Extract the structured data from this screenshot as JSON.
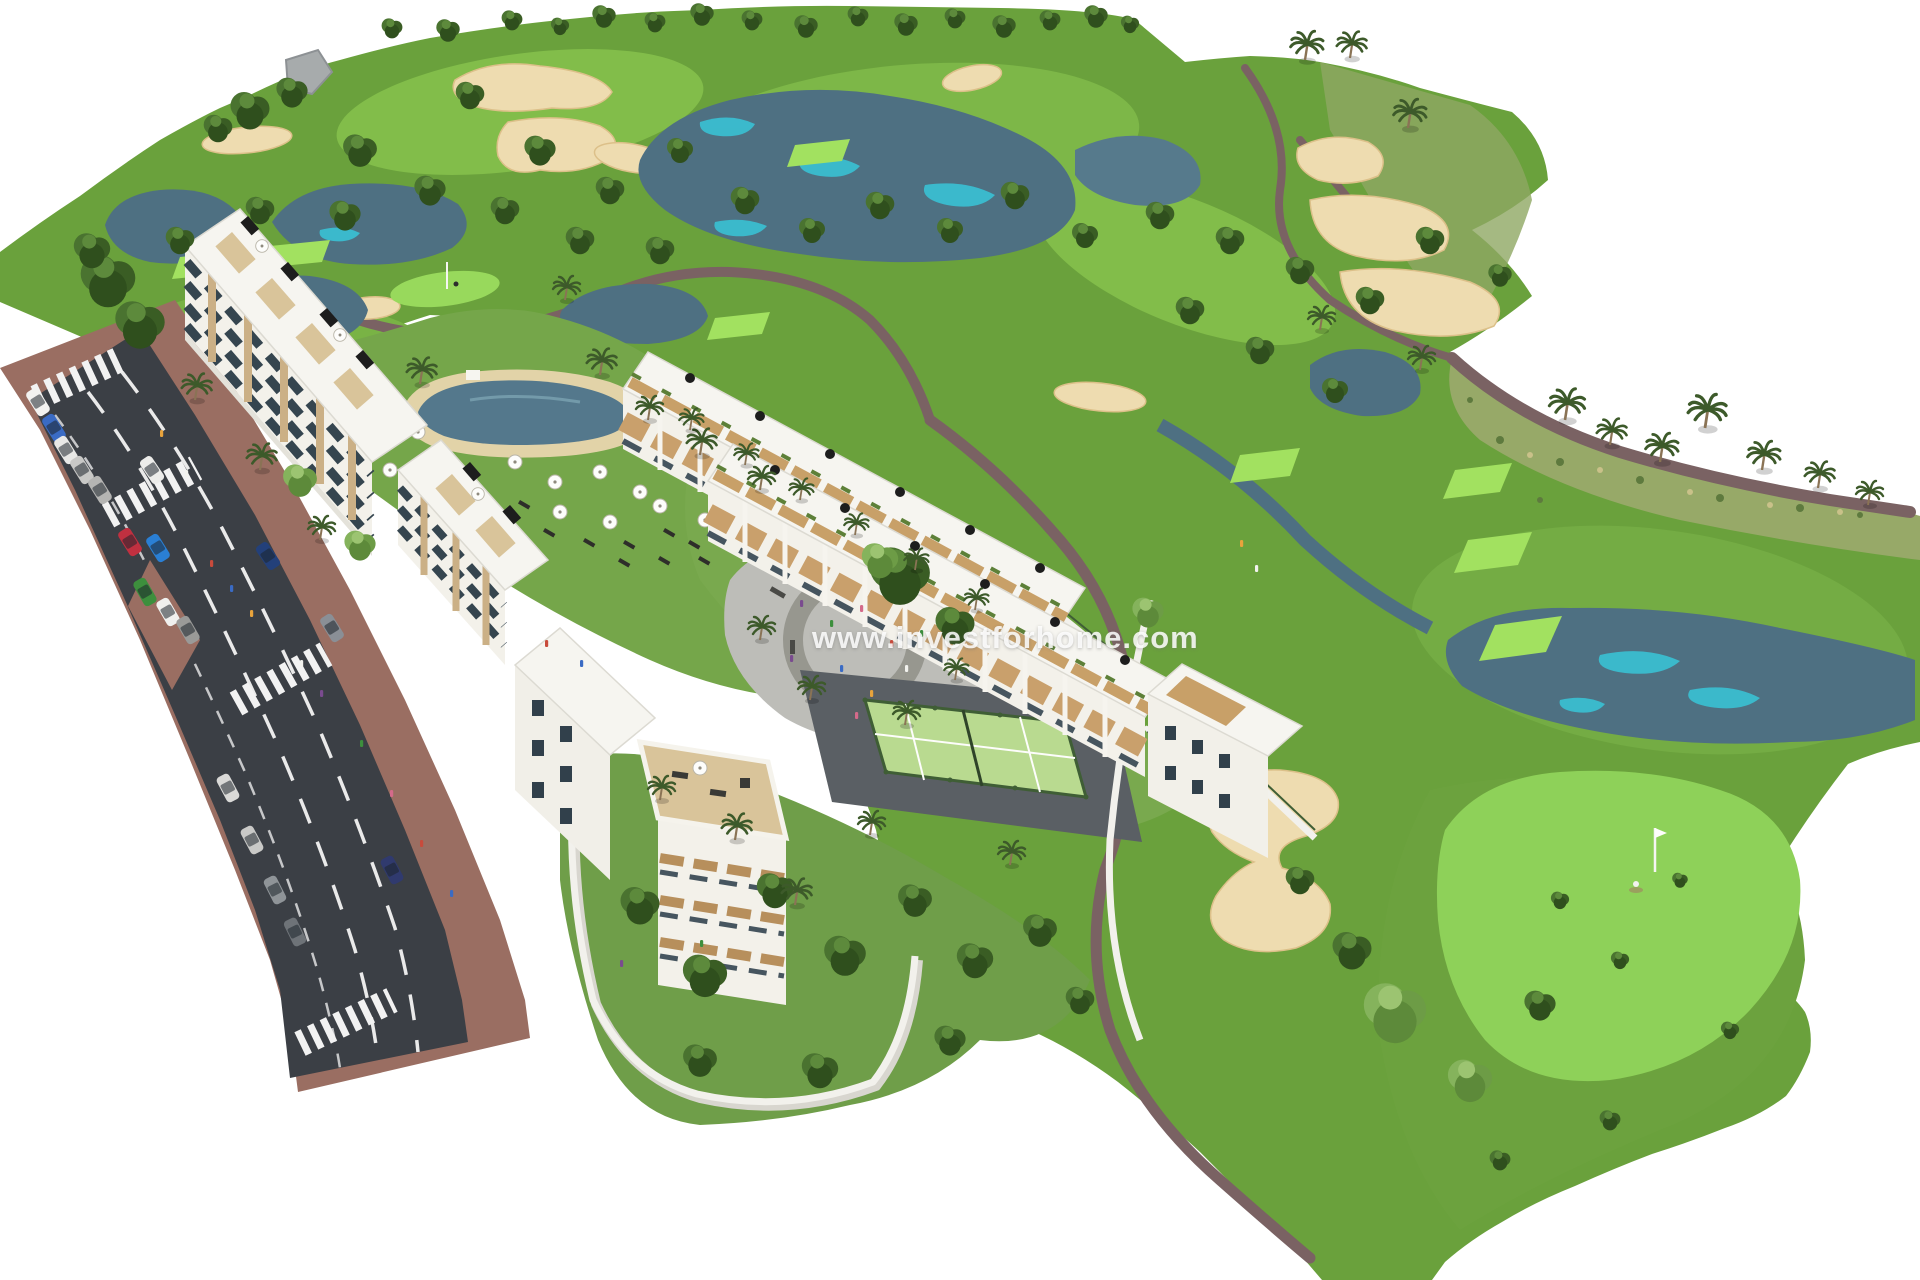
{
  "page": {
    "background": "#ffffff",
    "type": "aerial-3d-architectural-render"
  },
  "scene": {
    "title": "Aerial 3D render of a golf resort residential development",
    "areas": [
      {
        "name": "golf-course",
        "label": "Golf course with fairways, greens, sand bunkers and lakes"
      },
      {
        "name": "apartment-blocks",
        "label": "White apartment buildings with rooftop terraces"
      },
      {
        "name": "townhouse-rows",
        "label": "Townhouse rows with wooden pergola terraces"
      },
      {
        "name": "communal-pool",
        "label": "Lagoon-style pool with parasols and sun loungers"
      },
      {
        "name": "playground",
        "label": "Children's playground plaza"
      },
      {
        "name": "paddle-court",
        "label": "Paddle tennis court"
      },
      {
        "name": "avenue",
        "label": "Two-lane avenue with parked cars and zebra crossings"
      },
      {
        "name": "gardens",
        "label": "Walled community gardens with palms"
      }
    ],
    "palette": {
      "grass_mid": "#6aa13c",
      "grass_light": "#82bd4a",
      "green_bright": "#98d95c",
      "sand": "#eedcb0",
      "water": "#4e7082",
      "water_highlight": "#3ac1d4",
      "path": "#7a6263",
      "road": "#3b3f45",
      "sidewalk": "#9a6e62",
      "building_white": "#f5f3ec",
      "building_beige": "#c8ad83",
      "window_dark": "#31404b",
      "court_green": "#b9da90",
      "fence_green": "#3f5e35",
      "pool_deck": "#e2d3a8"
    }
  },
  "watermark": {
    "text": "www.investforhome.com"
  }
}
